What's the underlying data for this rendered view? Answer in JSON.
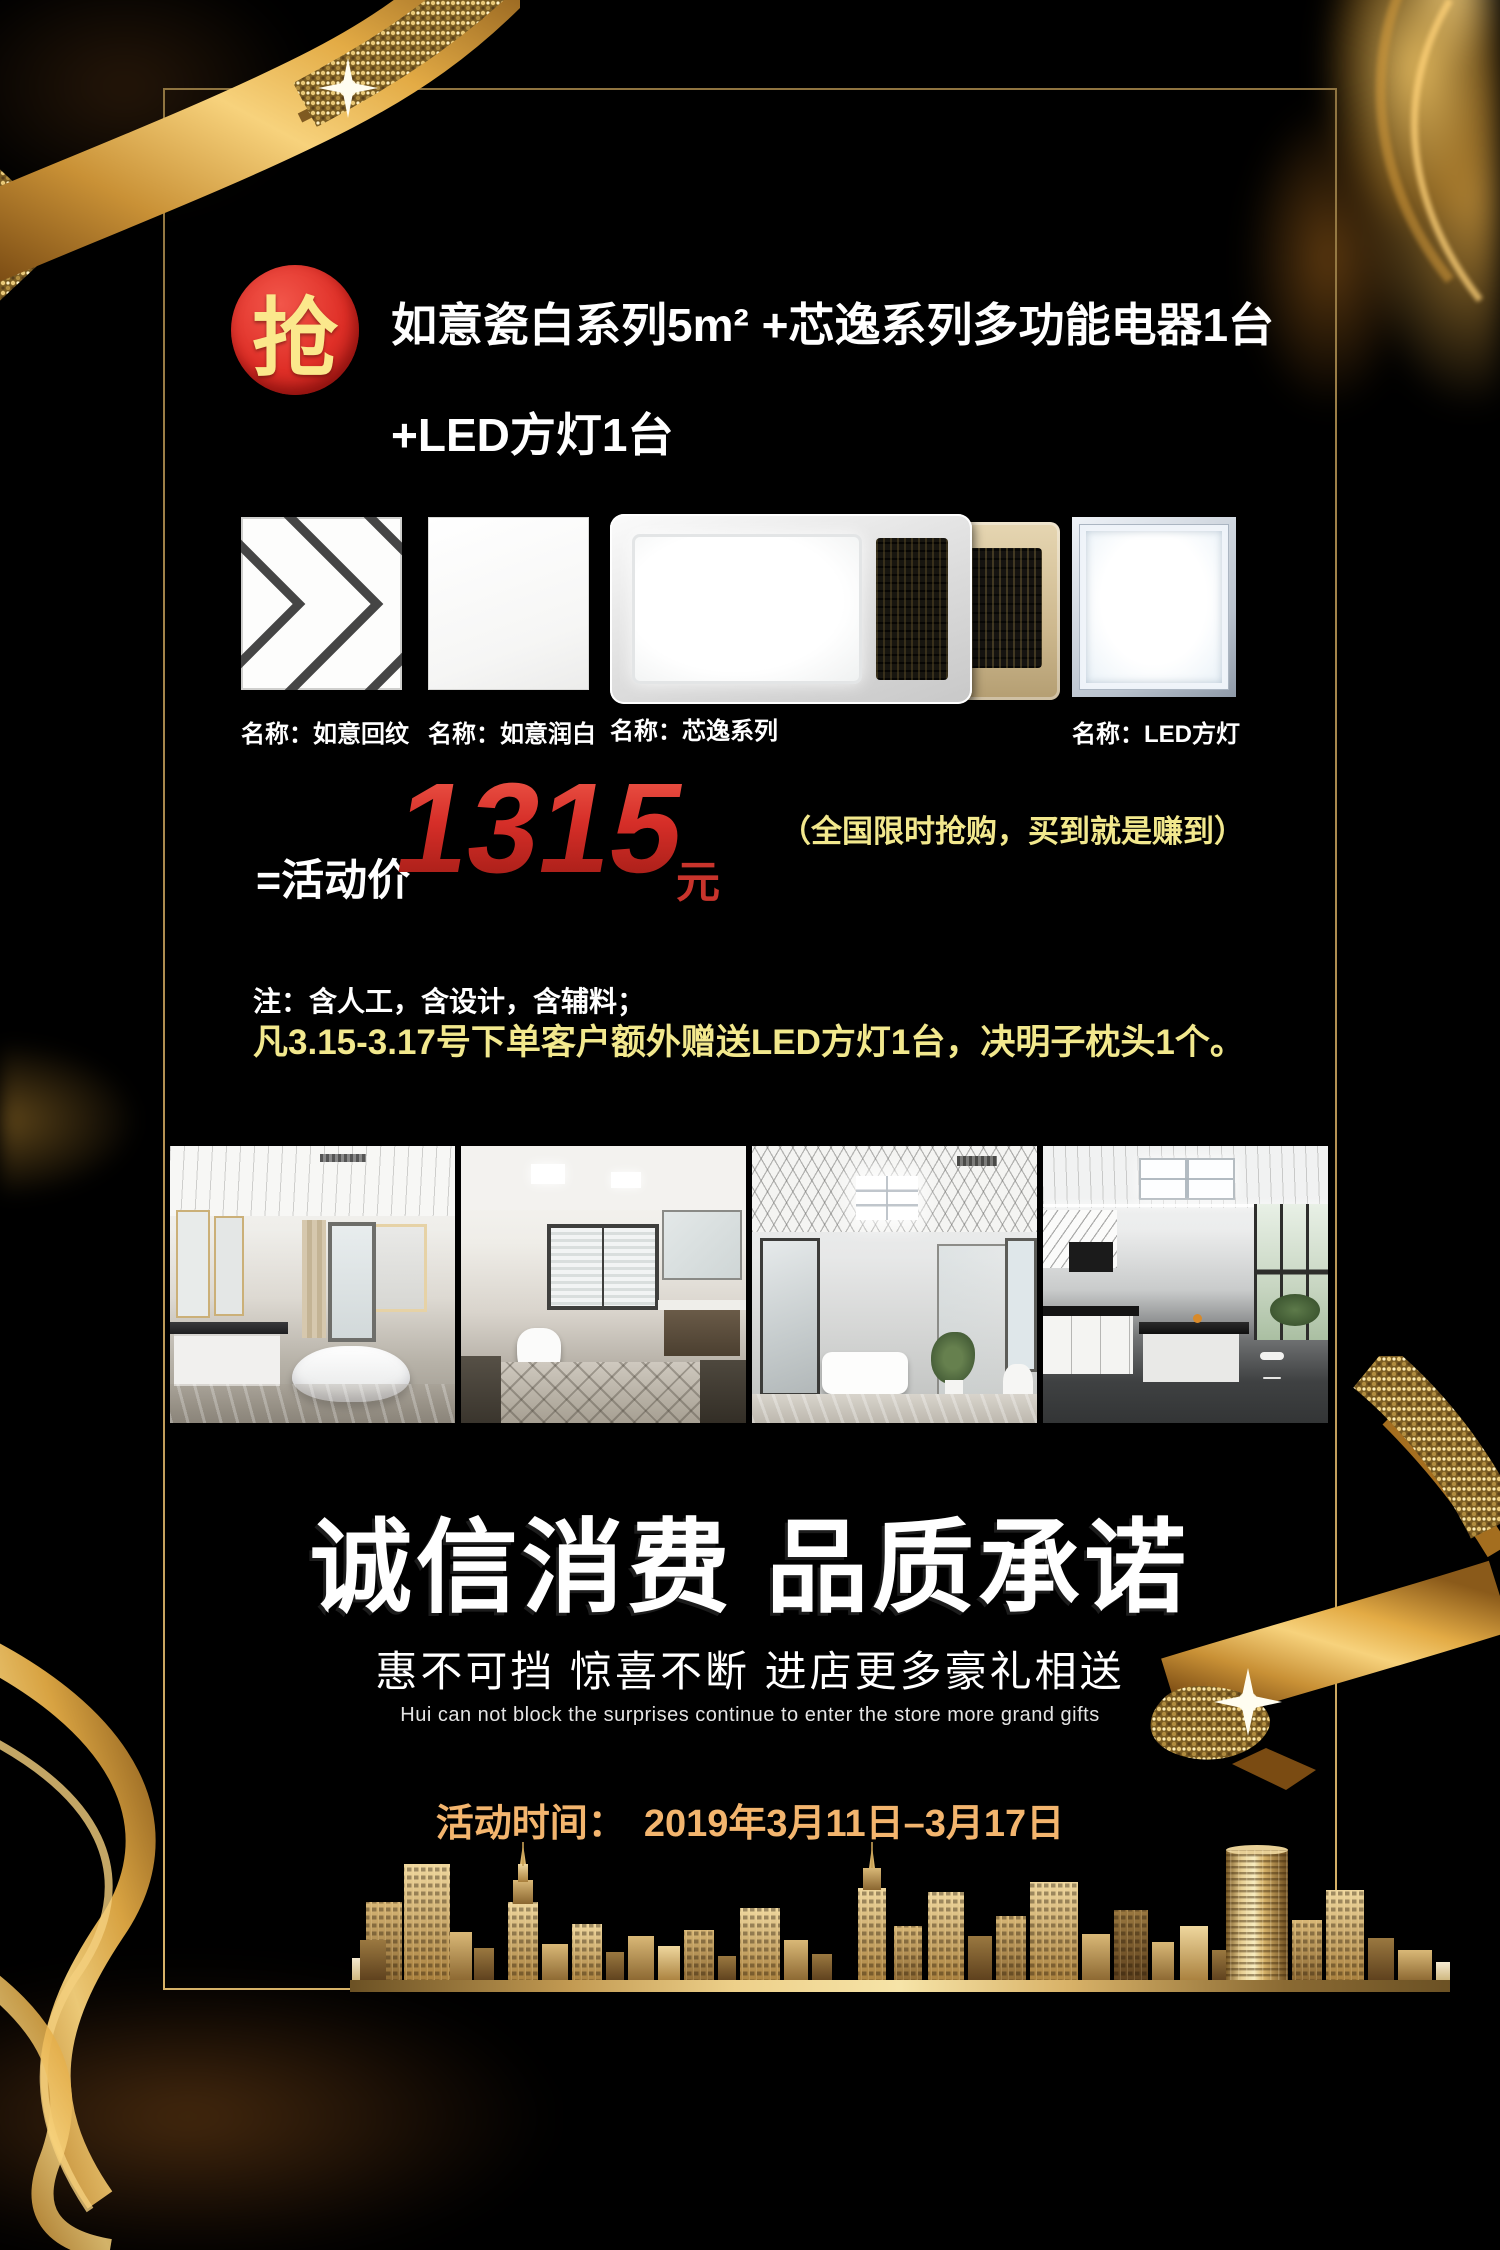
{
  "badge": {
    "label": "抢"
  },
  "offer": {
    "title_line1": "如意瓷白系列5m² +芯逸系列多功能电器1台",
    "title_line2": "+LED方灯1台"
  },
  "products": [
    {
      "label": "名称：如意回纹"
    },
    {
      "label": "名称：如意润白"
    },
    {
      "label": "名称：芯逸系列"
    },
    {
      "label": "名称：LED方灯"
    }
  ],
  "price": {
    "prefix": "=活动价",
    "amount": "1315",
    "unit": "元",
    "promo_note": "（全国限时抢购，买到就是赚到）"
  },
  "notes": {
    "line1": "注：含人工，含设计，含辅料；",
    "line2": "凡3.15-3.17号下单客户额外赠送LED方灯1台，决明子枕头1个。"
  },
  "slogan": {
    "heading": "诚信消费 品质承诺",
    "subheading": "惠不可挡 惊喜不断 进店更多豪礼相送",
    "subheading_en": "Hui can not block the surprises continue to enter the store more grand gifts"
  },
  "event": {
    "label": "活动时间：",
    "date": "2019年3月11日–3月17日"
  },
  "colors": {
    "accent_red": "#d6302b",
    "note_yellow": "#f2e88d",
    "date_gold": "#f3b56e",
    "gold": "#c9a158"
  }
}
